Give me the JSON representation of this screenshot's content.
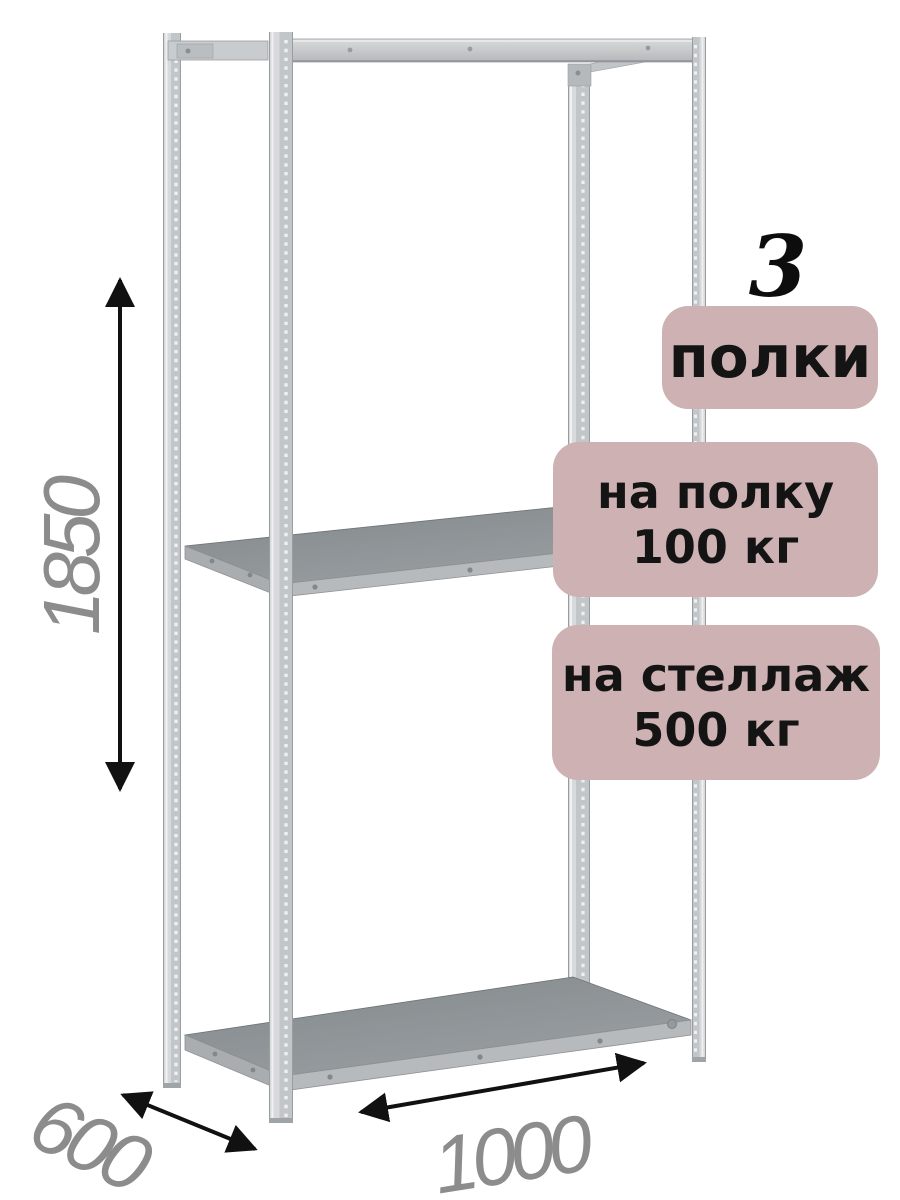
{
  "badges": {
    "count_number": "3",
    "count_label": "полки",
    "per_shelf": {
      "line1": "на полку",
      "line2": "100 кг"
    },
    "per_rack": {
      "line1": "на стеллаж",
      "line2": "500 кг"
    }
  },
  "dimensions": {
    "height_mm": "1850",
    "depth_mm": "600",
    "width_mm": "1000"
  },
  "illustration": {
    "subject": "metal-boltless-shelving-rack",
    "shelves_visible": 3,
    "posts_visible": 4
  },
  "colors": {
    "background": "#ffffff",
    "badge_bg": "#cdb1b3",
    "badge_text": "#141414",
    "dimension_text": "#8c8c8c",
    "arrow": "#111111",
    "metal_light": "#d7d9da",
    "metal_mid": "#c3c6c8",
    "shelf_surface": "#8e9396",
    "shelf_edge": "#b7babc"
  }
}
